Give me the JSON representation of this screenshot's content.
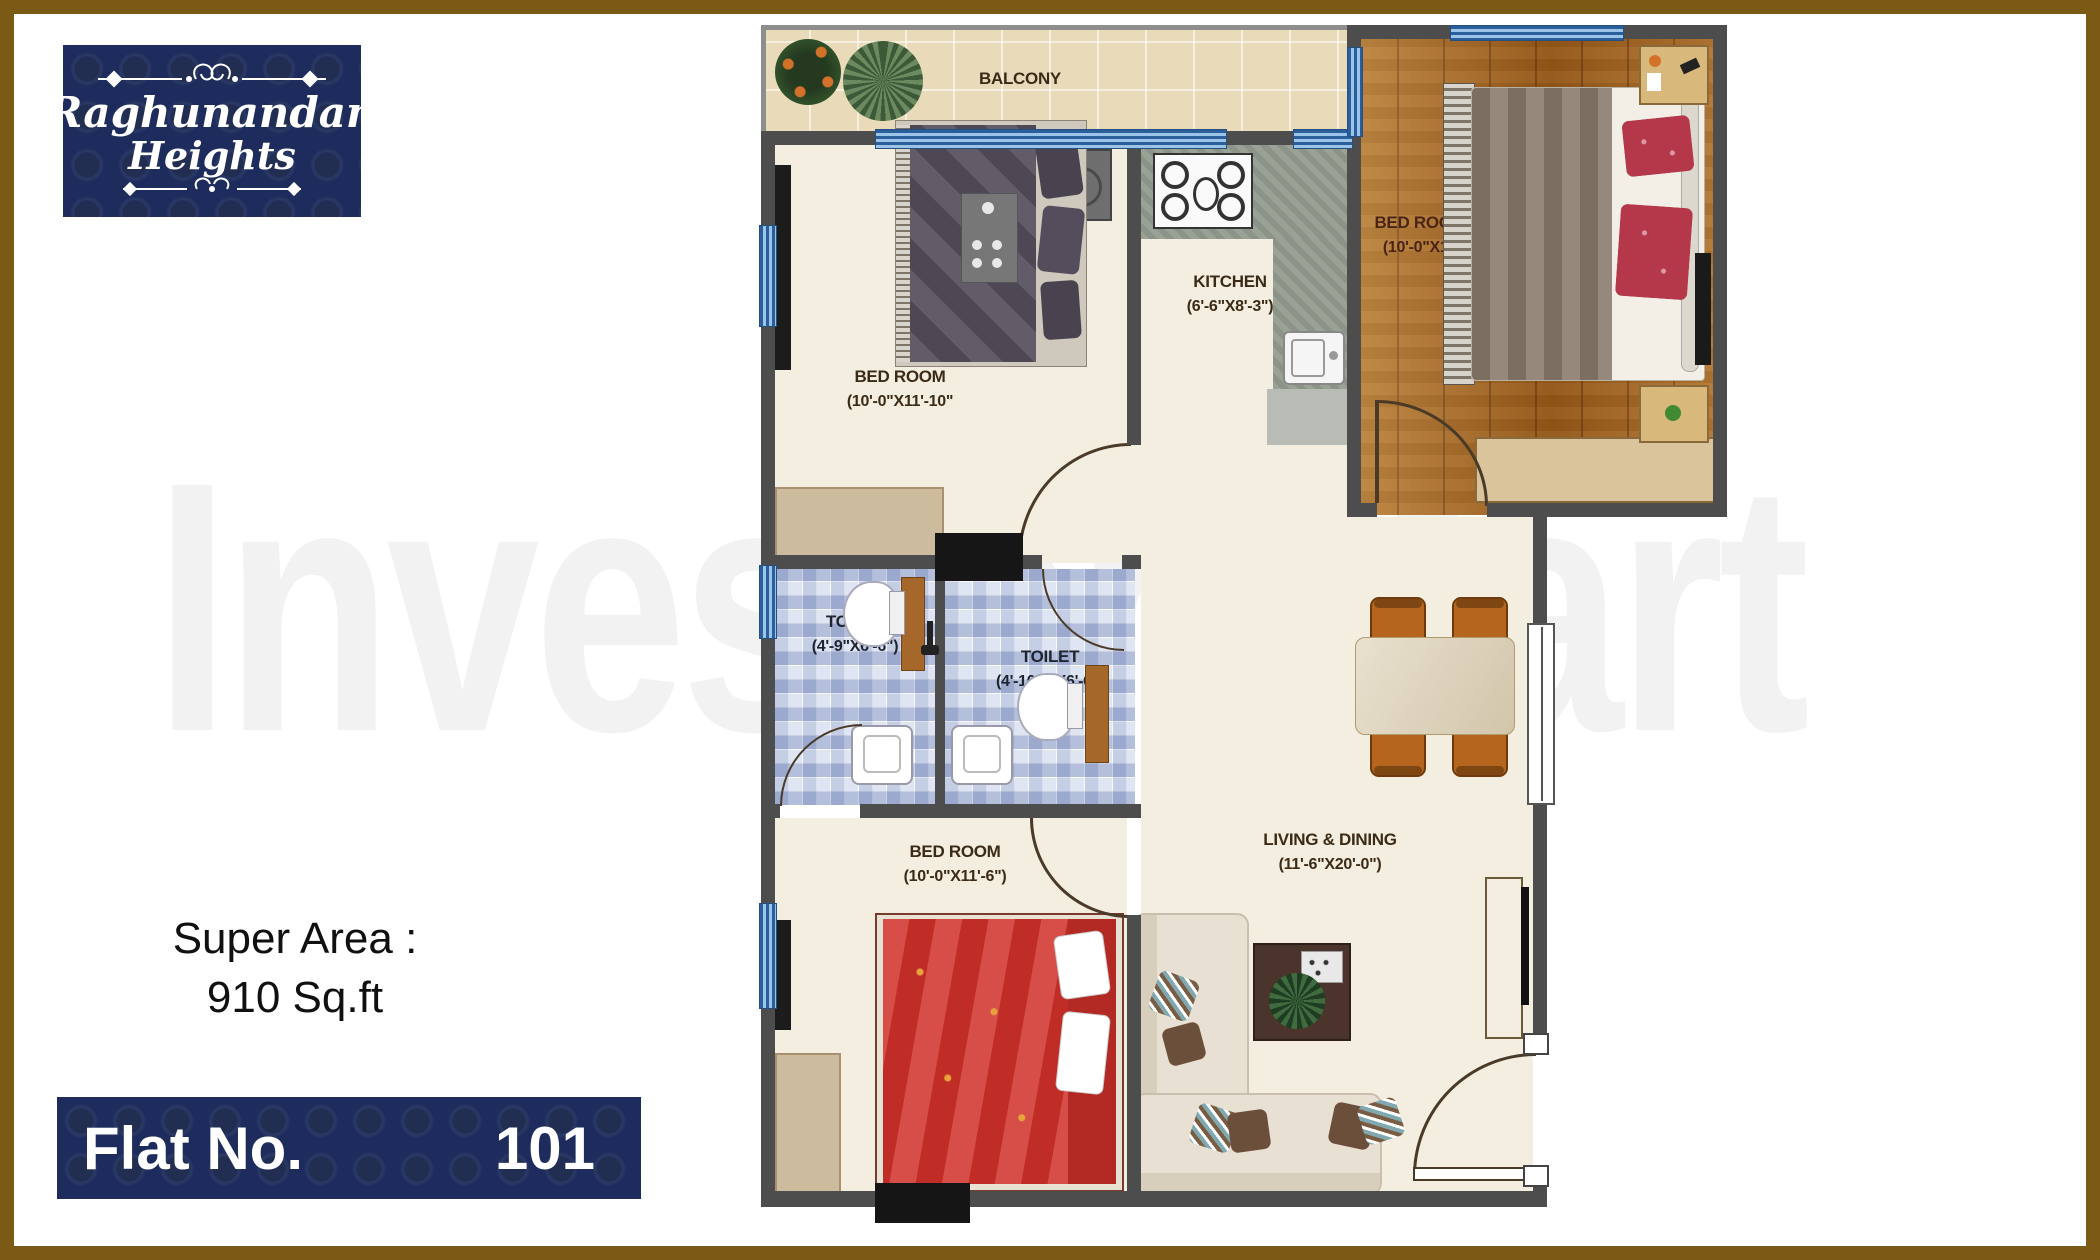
{
  "logo": {
    "line1": "Raghunandan",
    "line2": "Heights"
  },
  "left_panel": {
    "super_area_line1": "Super Area :",
    "super_area_line2": "910 Sq.ft",
    "flat_label": "Flat No.",
    "flat_number": "101"
  },
  "watermark": "Investor Mart",
  "rooms": {
    "balcony": {
      "name": "BALCONY"
    },
    "bedroom_top_left": {
      "name": "BED ROOM",
      "dims": "(10'-0\"X11'-10\""
    },
    "kitchen": {
      "name": "KITCHEN",
      "dims": "(6'-6\"X8'-3\")"
    },
    "bedroom_top_right": {
      "name": "BED ROOM",
      "dims": "(10'-0\"X13"
    },
    "toilet_left": {
      "name": "TOILET",
      "dims": "(4'-9\"X6'-6\")"
    },
    "toilet_right": {
      "name": "TOILET",
      "dims": "(4'-10½\"X6'-6\")"
    },
    "bedroom_bottom": {
      "name": "BED ROOM",
      "dims": "(10'-0\"X11'-6\")"
    },
    "living_dining": {
      "name": "LIVING & DINING",
      "dims": "(11'-6\"X20'-0\")"
    }
  },
  "colors": {
    "brand_navy": "#1d2c5c",
    "frame_gold": "#7b5a15",
    "wall_gray": "#4d4d4d",
    "floor_cream": "#f4eee1",
    "wood": "#a4651f",
    "tile_blue": "#cdd7ea",
    "accent_red": "#cf3129"
  }
}
